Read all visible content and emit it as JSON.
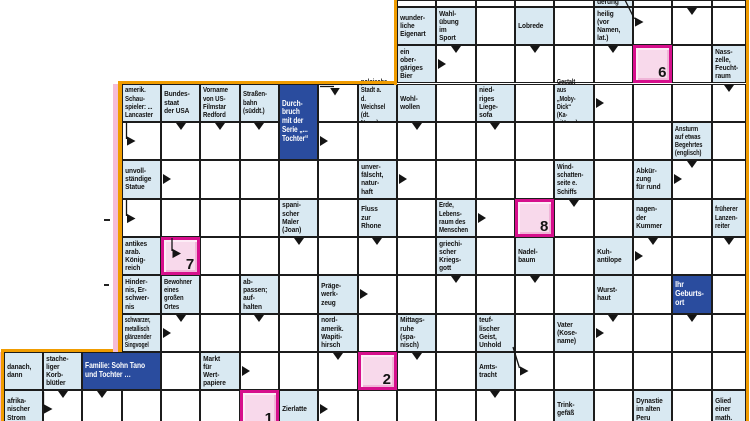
{
  "puzzle": {
    "kind": "arrow-crossword (Schwedenrätsel)",
    "language": "de",
    "colors": {
      "clue_bg": "#d9e9f2",
      "blue_clue_bg": "#2a4c9e",
      "line": "#1c1c1c",
      "solution_border": "#d60f8c",
      "solution_fill": "#f8d9eb",
      "outline_orange": "#f09c00",
      "outline_pink": "#f5bcd7",
      "text": "#121212",
      "blue_text": "#ffffff"
    },
    "grid": {
      "width": 750,
      "height": 421,
      "col_x": [
        3.5,
        42.85,
        82.2,
        121.55,
        160.9,
        200.25,
        239.6,
        278.95,
        318.3,
        357.65,
        397,
        436.35,
        475.7,
        515.05,
        554.4,
        593.75,
        633.1,
        672.45,
        711.8,
        746
      ],
      "row_y": [
        0,
        6.8,
        45.15,
        83.5,
        121.85,
        160.2,
        198.55,
        236.9,
        275.25,
        313.6,
        351.95,
        390.3,
        428.65
      ]
    },
    "cells": [
      {
        "r": 0,
        "c": 10,
        "k": "e"
      },
      {
        "r": 0,
        "c": 11,
        "k": "e"
      },
      {
        "r": 0,
        "c": 12,
        "k": "e"
      },
      {
        "r": 0,
        "c": 13,
        "k": "e"
      },
      {
        "r": 0,
        "c": 14,
        "k": "e"
      },
      {
        "r": 0,
        "c": 15,
        "k": "c",
        "t": "derung",
        "v": "b"
      },
      {
        "r": 0,
        "c": 16,
        "k": "e"
      },
      {
        "r": 0,
        "c": 17,
        "k": "e"
      },
      {
        "r": 0,
        "c": 18,
        "k": "e"
      },
      {
        "r": 1,
        "c": 10,
        "k": "c",
        "t": "wunder-\nliche\nEigenart"
      },
      {
        "r": 1,
        "c": 11,
        "k": "c",
        "t": "Wahl-\nübung\nim\nSport"
      },
      {
        "r": 1,
        "c": 12,
        "k": "e"
      },
      {
        "r": 1,
        "c": 13,
        "k": "c",
        "t": "Lobrede"
      },
      {
        "r": 1,
        "c": 14,
        "k": "e"
      },
      {
        "r": 1,
        "c": 15,
        "k": "c",
        "t": "heilig\n(vor\nNamen,\nlat.)"
      },
      {
        "r": 1,
        "c": 16,
        "k": "e"
      },
      {
        "r": 1,
        "c": 17,
        "k": "e",
        "a": [
          "d"
        ]
      },
      {
        "r": 1,
        "c": 18,
        "k": "e"
      },
      {
        "r": 2,
        "c": 10,
        "k": "c",
        "t": "ein\nober-\ngäriges\nBier"
      },
      {
        "r": 2,
        "c": 11,
        "k": "e",
        "a": [
          "d",
          "r"
        ]
      },
      {
        "r": 2,
        "c": 12,
        "k": "e"
      },
      {
        "r": 2,
        "c": 13,
        "k": "e",
        "a": [
          "d"
        ]
      },
      {
        "r": 2,
        "c": 14,
        "k": "e"
      },
      {
        "r": 2,
        "c": 15,
        "k": "e",
        "a": [
          "d"
        ]
      },
      {
        "r": 2,
        "c": 16,
        "k": "p",
        "n": "6"
      },
      {
        "r": 2,
        "c": 17,
        "k": "e"
      },
      {
        "r": 2,
        "c": 18,
        "k": "c",
        "t": "Nass-\nzelle,\nFeucht-\nraum"
      },
      {
        "r": 3,
        "c": 3,
        "k": "c",
        "t": "amerik.\nSchau-\nspieler: ...\nLancaster",
        "f": 0.8
      },
      {
        "r": 3,
        "c": 4,
        "k": "c",
        "t": "Bundes-\nstaat\nder USA"
      },
      {
        "r": 3,
        "c": 5,
        "k": "c",
        "t": "Vorname\nvon US-\nFilmstar\nRedford",
        "f": 0.8
      },
      {
        "r": 3,
        "c": 6,
        "k": "c",
        "t": "Straßen-\nbahn\n(süddt.)",
        "f": 0.8
      },
      {
        "r": 3,
        "c": 7,
        "k": "b",
        "rs": 2,
        "t": "Durch-\nbruch\nmit der\nSerie „...\nTochter“",
        "f": 0.8
      },
      {
        "r": 3,
        "c": 8,
        "k": "e"
      },
      {
        "r": 3,
        "c": 9,
        "k": "c",
        "t": "polnische\nStadt a. d.\nWeichsel\n(dt. Name)",
        "f": 0.76
      },
      {
        "r": 3,
        "c": 10,
        "k": "c",
        "t": "Wohl-\nwollen"
      },
      {
        "r": 3,
        "c": 11,
        "k": "e"
      },
      {
        "r": 3,
        "c": 12,
        "k": "c",
        "t": "nied-\nriges\nLiege-\nsofa"
      },
      {
        "r": 3,
        "c": 13,
        "k": "e"
      },
      {
        "r": 3,
        "c": 14,
        "k": "c",
        "t": "Gestalt aus\n„Moby-\nDick“ (Ka-\npitän ...)",
        "f": 0.73
      },
      {
        "r": 3,
        "c": 15,
        "k": "e",
        "a": [
          "r"
        ]
      },
      {
        "r": 3,
        "c": 16,
        "k": "e"
      },
      {
        "r": 3,
        "c": 17,
        "k": "e"
      },
      {
        "r": 3,
        "c": 18,
        "k": "e",
        "a": [
          "d"
        ]
      },
      {
        "r": 4,
        "c": 3,
        "k": "e"
      },
      {
        "r": 4,
        "c": 4,
        "k": "e",
        "a": [
          "d"
        ]
      },
      {
        "r": 4,
        "c": 5,
        "k": "e",
        "a": [
          "d"
        ]
      },
      {
        "r": 4,
        "c": 6,
        "k": "e",
        "a": [
          "d"
        ]
      },
      {
        "r": 4,
        "c": 8,
        "k": "e",
        "a": [
          "r"
        ]
      },
      {
        "r": 4,
        "c": 9,
        "k": "e"
      },
      {
        "r": 4,
        "c": 10,
        "k": "e",
        "a": [
          "d"
        ]
      },
      {
        "r": 4,
        "c": 11,
        "k": "e"
      },
      {
        "r": 4,
        "c": 12,
        "k": "e",
        "a": [
          "d"
        ]
      },
      {
        "r": 4,
        "c": 13,
        "k": "e"
      },
      {
        "r": 4,
        "c": 14,
        "k": "e"
      },
      {
        "r": 4,
        "c": 15,
        "k": "e"
      },
      {
        "r": 4,
        "c": 16,
        "k": "e"
      },
      {
        "r": 4,
        "c": 17,
        "k": "c",
        "t": "Ansturm\nauf etwas\nBegehrtes\n(englisch)",
        "f": 0.76
      },
      {
        "r": 4,
        "c": 18,
        "k": "e"
      },
      {
        "r": 5,
        "c": 3,
        "k": "c",
        "t": "unvoll-\nständige\nStatue"
      },
      {
        "r": 5,
        "c": 4,
        "k": "e",
        "a": [
          "r"
        ]
      },
      {
        "r": 5,
        "c": 5,
        "k": "e"
      },
      {
        "r": 5,
        "c": 6,
        "k": "e"
      },
      {
        "r": 5,
        "c": 7,
        "k": "e"
      },
      {
        "r": 5,
        "c": 8,
        "k": "e"
      },
      {
        "r": 5,
        "c": 9,
        "k": "c",
        "t": "unver-\nfälscht,\nnatur-\nhaft"
      },
      {
        "r": 5,
        "c": 10,
        "k": "e",
        "a": [
          "r"
        ]
      },
      {
        "r": 5,
        "c": 11,
        "k": "e"
      },
      {
        "r": 5,
        "c": 12,
        "k": "e"
      },
      {
        "r": 5,
        "c": 13,
        "k": "e"
      },
      {
        "r": 5,
        "c": 14,
        "k": "c",
        "t": "Wind-\nschatten-\nseite e.\nSchiffs",
        "f": 0.8
      },
      {
        "r": 5,
        "c": 15,
        "k": "e"
      },
      {
        "r": 5,
        "c": 16,
        "k": "c",
        "t": "Abkür-\nzung\nfür rund"
      },
      {
        "r": 5,
        "c": 17,
        "k": "e",
        "a": [
          "d",
          "r"
        ]
      },
      {
        "r": 5,
        "c": 18,
        "k": "e"
      },
      {
        "r": 6,
        "c": 3,
        "k": "e"
      },
      {
        "r": 6,
        "c": 4,
        "k": "e"
      },
      {
        "r": 6,
        "c": 5,
        "k": "e"
      },
      {
        "r": 6,
        "c": 6,
        "k": "e"
      },
      {
        "r": 6,
        "c": 7,
        "k": "c",
        "t": "spani-\nscher\nMaler\n(Joan)"
      },
      {
        "r": 6,
        "c": 8,
        "k": "e"
      },
      {
        "r": 6,
        "c": 9,
        "k": "c",
        "t": "Fluss\nzur\nRhone"
      },
      {
        "r": 6,
        "c": 10,
        "k": "e"
      },
      {
        "r": 6,
        "c": 11,
        "k": "c",
        "t": "Erde,\nLebens-\nraum des\nMenschen",
        "f": 0.8
      },
      {
        "r": 6,
        "c": 12,
        "k": "e",
        "a": [
          "r"
        ]
      },
      {
        "r": 6,
        "c": 13,
        "k": "p",
        "n": "8"
      },
      {
        "r": 6,
        "c": 14,
        "k": "e",
        "a": [
          "d"
        ]
      },
      {
        "r": 6,
        "c": 15,
        "k": "e"
      },
      {
        "r": 6,
        "c": 16,
        "k": "c",
        "t": "nagen-\nder\nKummer"
      },
      {
        "r": 6,
        "c": 17,
        "k": "e"
      },
      {
        "r": 6,
        "c": 18,
        "k": "c",
        "t": "früherer\nLanzen-\nreiter",
        "f": 0.8
      },
      {
        "r": 7,
        "c": 3,
        "k": "c",
        "t": "antikes\narab.\nKönig-\nreich"
      },
      {
        "r": 7,
        "c": 4,
        "k": "p",
        "n": "7"
      },
      {
        "r": 7,
        "c": 5,
        "k": "e"
      },
      {
        "r": 7,
        "c": 6,
        "k": "e"
      },
      {
        "r": 7,
        "c": 7,
        "k": "e",
        "a": [
          "d"
        ]
      },
      {
        "r": 7,
        "c": 8,
        "k": "e"
      },
      {
        "r": 7,
        "c": 9,
        "k": "e",
        "a": [
          "d"
        ]
      },
      {
        "r": 7,
        "c": 10,
        "k": "e"
      },
      {
        "r": 7,
        "c": 11,
        "k": "c",
        "t": "griechi-\nscher\nKriegs-\ngott"
      },
      {
        "r": 7,
        "c": 12,
        "k": "e"
      },
      {
        "r": 7,
        "c": 13,
        "k": "c",
        "t": "Nadel-\nbaum"
      },
      {
        "r": 7,
        "c": 14,
        "k": "e"
      },
      {
        "r": 7,
        "c": 15,
        "k": "c",
        "t": "Kuh-\nantilope"
      },
      {
        "r": 7,
        "c": 16,
        "k": "e",
        "a": [
          "d",
          "r"
        ]
      },
      {
        "r": 7,
        "c": 17,
        "k": "e"
      },
      {
        "r": 7,
        "c": 18,
        "k": "e",
        "a": [
          "d"
        ]
      },
      {
        "r": 8,
        "c": 3,
        "k": "c",
        "t": "Hinder-\nnis, Er-\nschwer-\nnis"
      },
      {
        "r": 8,
        "c": 4,
        "k": "c",
        "t": "Bewohner\neines\ngroßen\nOrtes",
        "f": 0.78
      },
      {
        "r": 8,
        "c": 5,
        "k": "e"
      },
      {
        "r": 8,
        "c": 6,
        "k": "c",
        "t": "ab-\npassen;\nauf-\nhalten"
      },
      {
        "r": 8,
        "c": 7,
        "k": "e"
      },
      {
        "r": 8,
        "c": 8,
        "k": "c",
        "t": "Präge-\nwerk-\nzeug"
      },
      {
        "r": 8,
        "c": 9,
        "k": "e",
        "a": [
          "r"
        ]
      },
      {
        "r": 8,
        "c": 10,
        "k": "e"
      },
      {
        "r": 8,
        "c": 11,
        "k": "e",
        "a": [
          "d"
        ]
      },
      {
        "r": 8,
        "c": 12,
        "k": "e"
      },
      {
        "r": 8,
        "c": 13,
        "k": "e",
        "a": [
          "d"
        ]
      },
      {
        "r": 8,
        "c": 14,
        "k": "e"
      },
      {
        "r": 8,
        "c": 15,
        "k": "c",
        "t": "Wurst-\nhaut"
      },
      {
        "r": 8,
        "c": 16,
        "k": "e"
      },
      {
        "r": 8,
        "c": 17,
        "k": "b",
        "t": "Ihr\nGeburts-\nort"
      },
      {
        "r": 8,
        "c": 18,
        "k": "e"
      },
      {
        "r": 9,
        "c": 3,
        "k": "c",
        "t": "schwarzer,\nmetallisch\nglänzender\nSingvogel",
        "f": 0.68
      },
      {
        "r": 9,
        "c": 4,
        "k": "e",
        "a": [
          "d",
          "r"
        ]
      },
      {
        "r": 9,
        "c": 5,
        "k": "e"
      },
      {
        "r": 9,
        "c": 6,
        "k": "e",
        "a": [
          "d"
        ]
      },
      {
        "r": 9,
        "c": 7,
        "k": "e"
      },
      {
        "r": 9,
        "c": 8,
        "k": "c",
        "t": "nord-\namerik.\nWapiti-\nhirsch"
      },
      {
        "r": 9,
        "c": 9,
        "k": "e"
      },
      {
        "r": 9,
        "c": 10,
        "k": "c",
        "t": "Mittags-\nruhe\n(spa-\nnisch)"
      },
      {
        "r": 9,
        "c": 11,
        "k": "e"
      },
      {
        "r": 9,
        "c": 12,
        "k": "c",
        "t": "teuf-\nlischer\nGeist,\nUnhold"
      },
      {
        "r": 9,
        "c": 13,
        "k": "e"
      },
      {
        "r": 9,
        "c": 14,
        "k": "c",
        "t": "Vater\n(Kose-\nname)"
      },
      {
        "r": 9,
        "c": 15,
        "k": "e",
        "a": [
          "d",
          "r"
        ]
      },
      {
        "r": 9,
        "c": 16,
        "k": "e"
      },
      {
        "r": 9,
        "c": 17,
        "k": "e",
        "a": [
          "d"
        ]
      },
      {
        "r": 9,
        "c": 18,
        "k": "e"
      },
      {
        "r": 10,
        "c": 0,
        "k": "c",
        "t": "danach,\ndann"
      },
      {
        "r": 10,
        "c": 1,
        "k": "c",
        "t": "stache-\nliger\nKorb-\nblütler"
      },
      {
        "r": 10,
        "c": 2,
        "k": "b",
        "cs": 2,
        "t": "Familie: Sohn Tano\nund Tochter …",
        "f": 0.82
      },
      {
        "r": 10,
        "c": 4,
        "k": "e"
      },
      {
        "r": 10,
        "c": 5,
        "k": "c",
        "t": "Markt\nfür\nWert-\npapiere"
      },
      {
        "r": 10,
        "c": 6,
        "k": "e",
        "a": [
          "r"
        ]
      },
      {
        "r": 10,
        "c": 7,
        "k": "e"
      },
      {
        "r": 10,
        "c": 8,
        "k": "e",
        "a": [
          "d"
        ]
      },
      {
        "r": 10,
        "c": 9,
        "k": "p",
        "n": "2"
      },
      {
        "r": 10,
        "c": 10,
        "k": "e",
        "a": [
          "d"
        ]
      },
      {
        "r": 10,
        "c": 11,
        "k": "e"
      },
      {
        "r": 10,
        "c": 12,
        "k": "c",
        "t": "Amts-\ntracht"
      },
      {
        "r": 10,
        "c": 13,
        "k": "e"
      },
      {
        "r": 10,
        "c": 14,
        "k": "e"
      },
      {
        "r": 10,
        "c": 15,
        "k": "e"
      },
      {
        "r": 10,
        "c": 16,
        "k": "e"
      },
      {
        "r": 10,
        "c": 17,
        "k": "e"
      },
      {
        "r": 10,
        "c": 18,
        "k": "e"
      },
      {
        "r": 11,
        "c": 0,
        "k": "c",
        "t": "afrika-\nnischer\nStrom"
      },
      {
        "r": 11,
        "c": 1,
        "k": "e",
        "a": [
          "d"
        ]
      },
      {
        "r": 11,
        "c": 2,
        "k": "e",
        "a": [
          "d"
        ]
      },
      {
        "r": 11,
        "c": 3,
        "k": "e"
      },
      {
        "r": 11,
        "c": 4,
        "k": "e"
      },
      {
        "r": 11,
        "c": 5,
        "k": "e"
      },
      {
        "r": 11,
        "c": 6,
        "k": "p",
        "n": "1"
      },
      {
        "r": 11,
        "c": 7,
        "k": "c",
        "t": "Zierlatte"
      },
      {
        "r": 11,
        "c": 8,
        "k": "e",
        "a": [
          "r"
        ]
      },
      {
        "r": 11,
        "c": 9,
        "k": "e"
      },
      {
        "r": 11,
        "c": 10,
        "k": "e"
      },
      {
        "r": 11,
        "c": 11,
        "k": "e"
      },
      {
        "r": 11,
        "c": 12,
        "k": "e",
        "a": [
          "d"
        ]
      },
      {
        "r": 11,
        "c": 13,
        "k": "e"
      },
      {
        "r": 11,
        "c": 14,
        "k": "c",
        "t": "Trink-\ngefäß"
      },
      {
        "r": 11,
        "c": 15,
        "k": "e"
      },
      {
        "r": 11,
        "c": 16,
        "k": "c",
        "t": "Dynastie\nim alten\nPeru"
      },
      {
        "r": 11,
        "c": 17,
        "k": "e"
      },
      {
        "r": 11,
        "c": 18,
        "k": "c",
        "t": "Glied\neiner\nmath."
      }
    ],
    "overlay_arrows": [
      {
        "x1": 625,
        "y1": 0,
        "x2": 634.5,
        "y2": 19,
        "tip": "r",
        "tx": 635,
        "ty": 22
      },
      {
        "x1": 320,
        "y1": 86.5,
        "x2": 334,
        "y2": 86.5,
        "tip": "d",
        "tx": 335,
        "ty": 88
      },
      {
        "x1": 126.5,
        "y1": 123,
        "x2": 126.5,
        "y2": 139,
        "tip": "r",
        "tx": 127,
        "ty": 141
      },
      {
        "x1": 126.5,
        "y1": 200,
        "x2": 126.5,
        "y2": 216,
        "tip": "r",
        "tx": 127,
        "ty": 218.5
      },
      {
        "x1": 172,
        "y1": 238,
        "x2": 172,
        "y2": 251,
        "tip": "r",
        "tx": 172.5,
        "ty": 253.5
      },
      {
        "x1": 513,
        "y1": 347,
        "x2": 519.5,
        "y2": 368,
        "tip": "r",
        "tx": 520,
        "ty": 371
      },
      {
        "x1": 43.5,
        "y1": 392,
        "x2": 43.5,
        "y2": 406,
        "tip": "r",
        "tx": 44,
        "ty": 409
      }
    ],
    "decor": [
      {
        "name": "grid-outline-orange-right",
        "x": 745.7,
        "y": 0,
        "w": 3.3,
        "h": 421,
        "c": "#f09c00"
      },
      {
        "name": "grid-outline-orange-upper-left",
        "x": 393.6,
        "y": 0,
        "w": 3.4,
        "h": 84.5,
        "c": "#f09c00"
      },
      {
        "name": "grid-outline-orange-step-top",
        "x": 118.3,
        "y": 80.5,
        "w": 278.7,
        "h": 3.2,
        "c": "#f09c00"
      },
      {
        "name": "grid-outline-orange-mid-left",
        "x": 118.3,
        "y": 80.5,
        "w": 3.3,
        "h": 271.5,
        "c": "#f09c00"
      },
      {
        "name": "grid-outline-orange-step-low",
        "x": 1.2,
        "y": 348.9,
        "w": 120.3,
        "h": 3.2,
        "c": "#f09c00"
      },
      {
        "name": "grid-outline-orange-lower-left",
        "x": 1.2,
        "y": 348.9,
        "w": 3.3,
        "h": 72.1,
        "c": "#f09c00"
      },
      {
        "name": "pink-strip-left",
        "x": 113.2,
        "y": 83.5,
        "w": 5.1,
        "h": 268.5,
        "c": "#f5bcd7"
      },
      {
        "name": "pink-strip-lower-left",
        "x": 0,
        "y": 352,
        "w": 1.4,
        "h": 69,
        "c": "#f5bcd7"
      },
      {
        "name": "stray-mark",
        "x": 104,
        "y": 219,
        "w": 5.5,
        "h": 2,
        "c": "#222222"
      },
      {
        "name": "stray-mark",
        "x": 103.5,
        "y": 283.8,
        "w": 5.5,
        "h": 2,
        "c": "#222222"
      }
    ]
  }
}
